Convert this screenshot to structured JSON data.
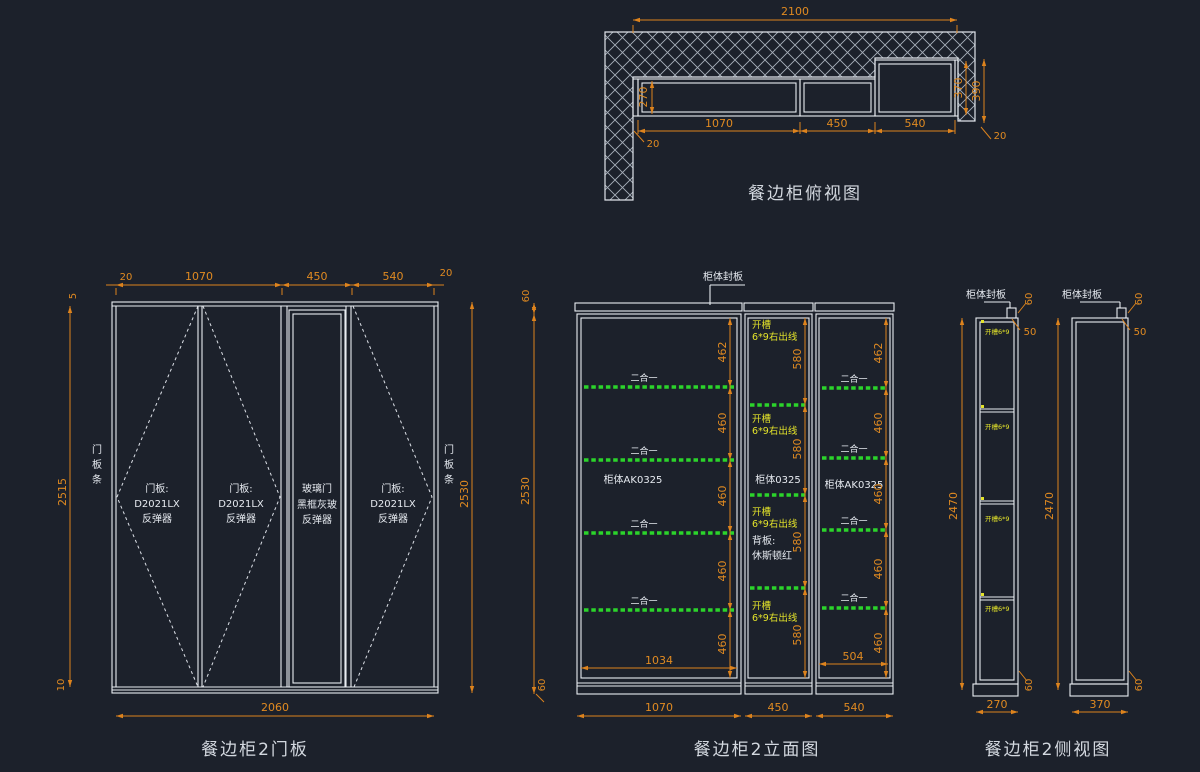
{
  "canvas": {
    "width": 1200,
    "height": 772,
    "background": "#1c212b"
  },
  "palette": {
    "line": "#e9edf2",
    "dimension": "#dd831d",
    "shelf_green": "#2bd42b",
    "slot_yellow": "#e3e32a",
    "text": "#e6eaf0"
  },
  "top_view": {
    "title": "餐边柜俯视图",
    "dim_total_width": "2100",
    "dim_depth": "270",
    "dim_sections": [
      "1070",
      "450",
      "540"
    ],
    "dim_gap_left": "20",
    "dim_gap_right": "20",
    "dim_right_depth": "370",
    "dim_right_total": "390"
  },
  "door_view": {
    "title": "餐边柜2门板",
    "top_dims": [
      "20",
      "1070",
      "450",
      "540",
      "20"
    ],
    "dim_top_strip": "5",
    "dim_bottom_strip": "10",
    "dim_height_left": "2515",
    "dim_height_right": "2530",
    "dim_bottom_width": "2060",
    "side_strip_chars": [
      "门",
      "板",
      "条"
    ],
    "doors": [
      {
        "line1": "门板:",
        "line2": "D2021LX",
        "line3": "反弹器"
      },
      {
        "line1": "门板:",
        "line2": "D2021LX",
        "line3": "反弹器"
      },
      {
        "line1": "玻璃门",
        "line2": "黑框灰玻",
        "line3": "反弹器"
      },
      {
        "line1": "门板:",
        "line2": "D2021LX",
        "line3": "反弹器"
      }
    ]
  },
  "elevation_view": {
    "title": "餐边柜2立面图",
    "cap_label": "柜体封板",
    "dim_cap": "60",
    "dim_height": "2530",
    "dim_base": "60",
    "left_section_dims": [
      "462",
      "460",
      "460",
      "460",
      "460"
    ],
    "middle_section_dims": [
      "580",
      "580",
      "580",
      "580"
    ],
    "right_section_dims": [
      "462",
      "460",
      "460",
      "460",
      "460"
    ],
    "dim_left_inner": "1034",
    "dim_right_inner": "504",
    "bottom_dims": [
      "1070",
      "450",
      "540"
    ],
    "left_cabinet_label": "柜体AK0325",
    "middle_cabinet_label": "柜体0325",
    "right_cabinet_label": "柜体AK0325",
    "connector_label": "二合一",
    "slot_label_line1": "开槽",
    "slot_label_line2": "6*9右出线",
    "back_panel_line1": "背板:",
    "back_panel_line2": "休斯顿红"
  },
  "side_view": {
    "title": "餐边柜2侧视图",
    "cap_label": "柜体封板",
    "dim_cap": "60",
    "dim_offset": "50",
    "dim_base": "60",
    "dim_height": "2470",
    "dim_left_depth": "270",
    "dim_right_depth": "370",
    "slot_label": "开槽6*9"
  }
}
